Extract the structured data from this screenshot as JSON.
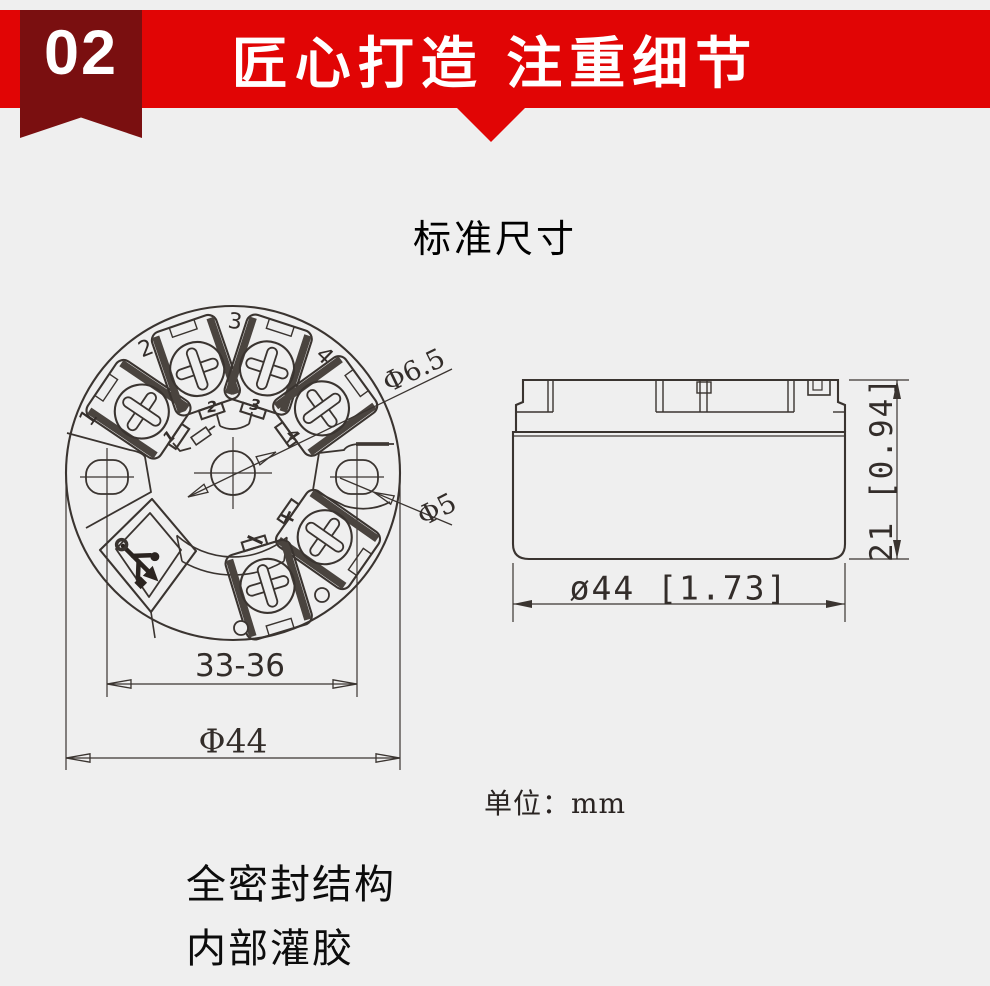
{
  "colors": {
    "background": "#efefef",
    "banner_red": "#e10505",
    "ribbon_dark_red": "#7a0f10",
    "line_ink": "#3a3430",
    "text_black": "#111111"
  },
  "banner": {
    "number": "02",
    "title": "匠心打造 注重细节"
  },
  "section": {
    "title": "标准尺寸"
  },
  "top_view": {
    "terminal_labels": [
      "1",
      "2",
      "3",
      "4"
    ],
    "wiring_labels": [
      "1",
      "2",
      "3",
      "4"
    ],
    "polarity": {
      "plus": "+",
      "minus": "−"
    },
    "dims": {
      "center_hole": "Φ6.5",
      "side_hole": "Φ5",
      "hole_spacing": "33-36",
      "outer_diameter": "Φ44"
    }
  },
  "side_view": {
    "dims": {
      "height": "21 [0.94]",
      "diameter": "ø44 [1.73]"
    }
  },
  "unit_note": "单位：mm",
  "features": [
    "全密封结构",
    "内部灌胶"
  ]
}
